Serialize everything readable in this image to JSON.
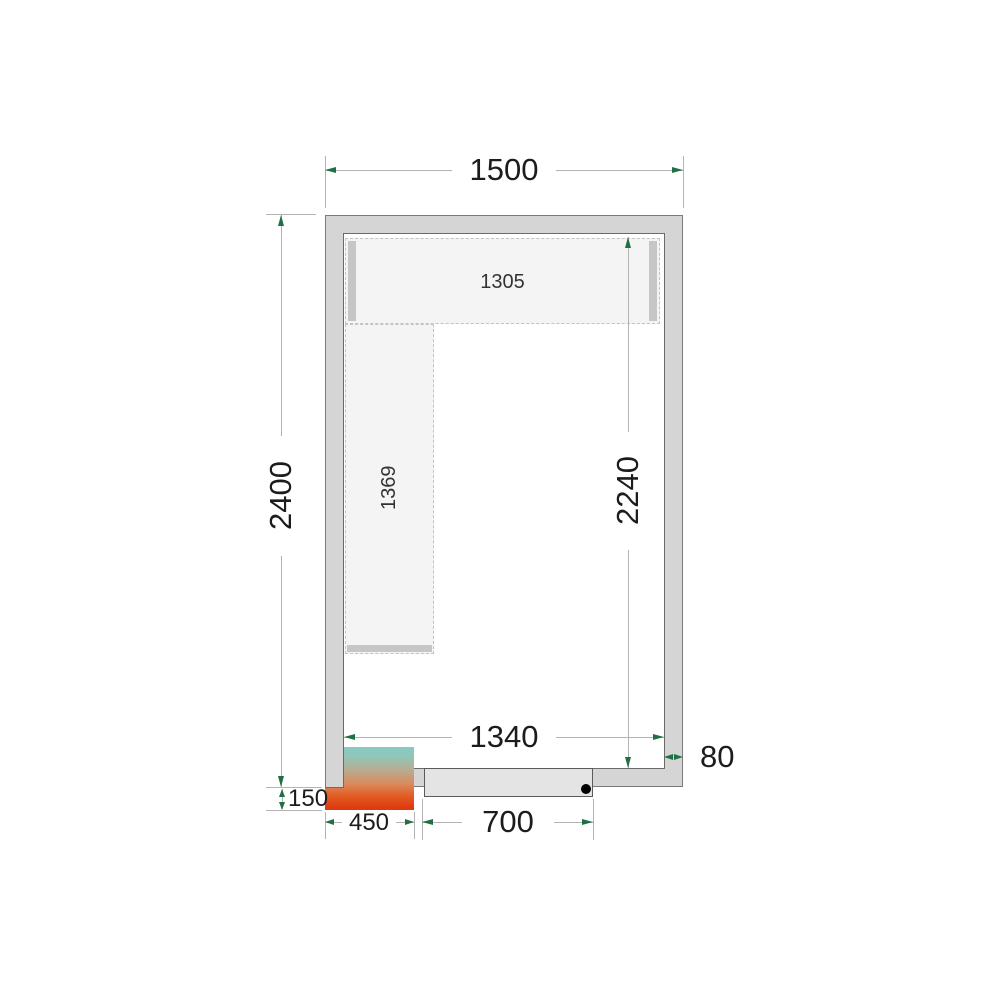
{
  "drawing": {
    "type": "cold-room-floor-plan",
    "dimensions": {
      "outer_width": "1500",
      "outer_depth": "2400",
      "inner_depth": "2240",
      "inner_width": "1340",
      "shelf_top_length": "1305",
      "shelf_left_length": "1369",
      "door_width": "700",
      "unit_width": "450",
      "unit_protrusion": "150",
      "wall_thickness": "80"
    },
    "colors": {
      "wall_fill": "#d5d5d5",
      "wall_outline": "#7a7a7a",
      "wall_outline_inner": "#6b6b6b",
      "dim_line": "#b3b3b3",
      "arrow_green": "#1f7044",
      "text_dark": "#1c1c1c",
      "shelf_fill": "#f4f4f4",
      "shelf_border": "#c3c3c3",
      "shelf_support": "#c6c6c6",
      "door_fill": "#e4e4e4",
      "door_outline": "#5a5a5a",
      "handle_dot": "#000000",
      "unit_top": "#86cbc3",
      "unit_mid": "#d98b5e",
      "unit_bottom": "#df3b10"
    }
  }
}
